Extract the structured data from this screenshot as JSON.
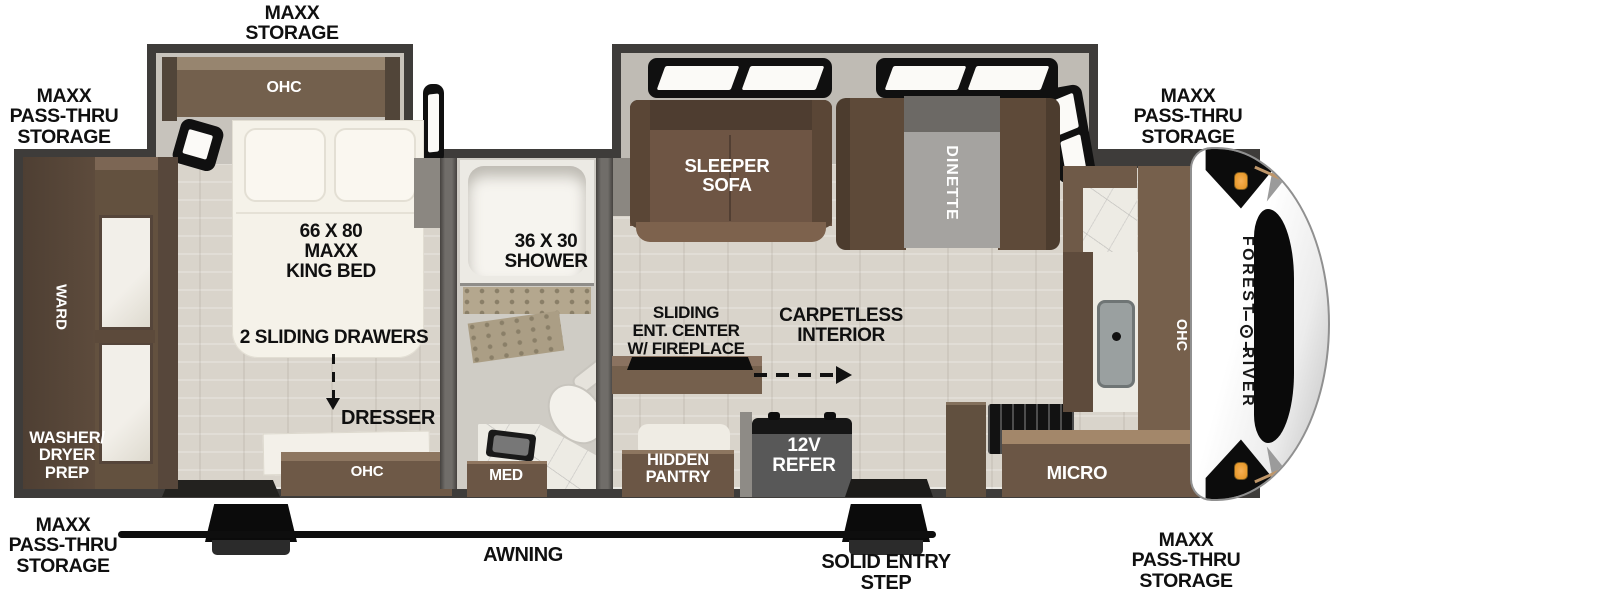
{
  "floorplan": {
    "brand": {
      "forest": "FOREST",
      "river": "RIVER"
    },
    "labels": {
      "maxx_storage_top": "MAXX\nSTORAGE",
      "maxx_passthru": "MAXX\nPASS-THRU\nSTORAGE",
      "ohc": "OHC",
      "king_bed": "66 X 80\nMAXX\nKING BED",
      "sliding_drawers": "2 SLIDING DRAWERS",
      "dresser": "DRESSER",
      "ward": "WARD",
      "washer_dryer_prep": "WASHER/\nDRYER\nPREP",
      "shower": "36 X 30\nSHOWER",
      "med": "MED",
      "sleeper_sofa": "SLEEPER\nSOFA",
      "dinette": "DINETTE",
      "sliding_ent_center": "SLIDING\nENT. CENTER\nW/ FIREPLACE",
      "carpetless_interior": "CARPETLESS\nINTERIOR",
      "hidden_pantry": "HIDDEN\nPANTRY",
      "refer_12v": "12V\nREFER",
      "micro": "MICRO",
      "awning": "AWNING",
      "solid_entry_step": "SOLID ENTRY\nSTEP"
    },
    "colors": {
      "wall": "#3e3c3a",
      "floor": "#d9d4cb",
      "cabinet_brown": "#6b5645",
      "marker_light": "#f2a344"
    }
  }
}
